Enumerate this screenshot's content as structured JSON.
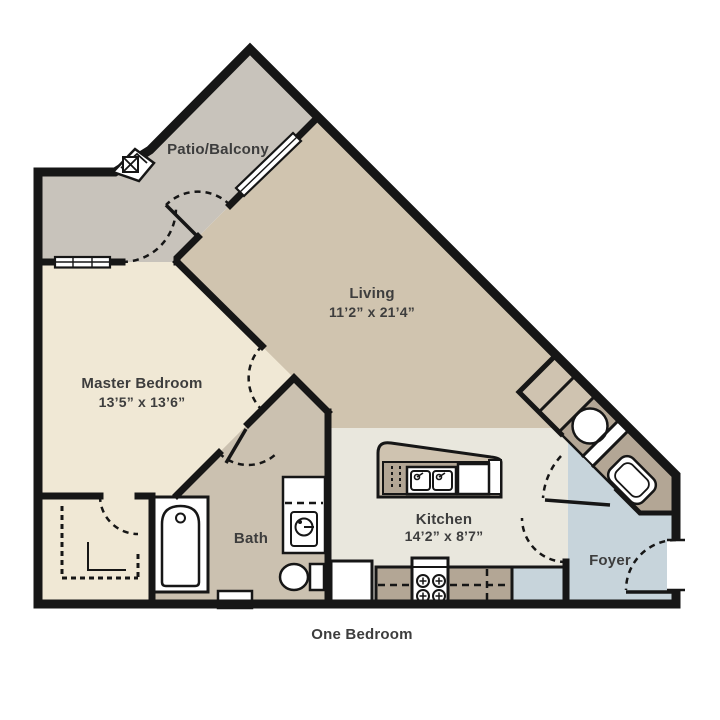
{
  "plan": {
    "title": "One Bedroom",
    "rooms": {
      "patio": {
        "label": "Patio/Balcony"
      },
      "living": {
        "label": "Living",
        "dimensions": "11’2” x 21’4”"
      },
      "master_bedroom": {
        "label": "Master Bedroom",
        "dimensions": "13’5” x 13’6”"
      },
      "bath": {
        "label": "Bath"
      },
      "kitchen": {
        "label": "Kitchen",
        "dimensions": "14’2” x 8’7”"
      },
      "foyer": {
        "label": "Foyer"
      }
    },
    "fixtures": [
      "bathtub",
      "toilet",
      "vanity-sink",
      "walk-in-closet",
      "kitchen-island",
      "double-sink",
      "dishwasher",
      "range-4-burner",
      "refrigerator",
      "pantry-closet",
      "washer",
      "utility-sink",
      "coat-closet",
      "entry-door",
      "sliding-glass-door",
      "window",
      "support-column"
    ],
    "colors": {
      "background": "#ffffff",
      "wall": "#161616",
      "patio": "#c8c3bb",
      "living": "#d0c4af",
      "bedroom": "#f0e8d5",
      "bath": "#cbc1b0",
      "kitchen": "#e9e7dd",
      "foyer": "#c7d4db",
      "cabinet": "#b3a695",
      "cabinet_light": "#cfc3b0",
      "text": "#3d3d3d"
    }
  }
}
